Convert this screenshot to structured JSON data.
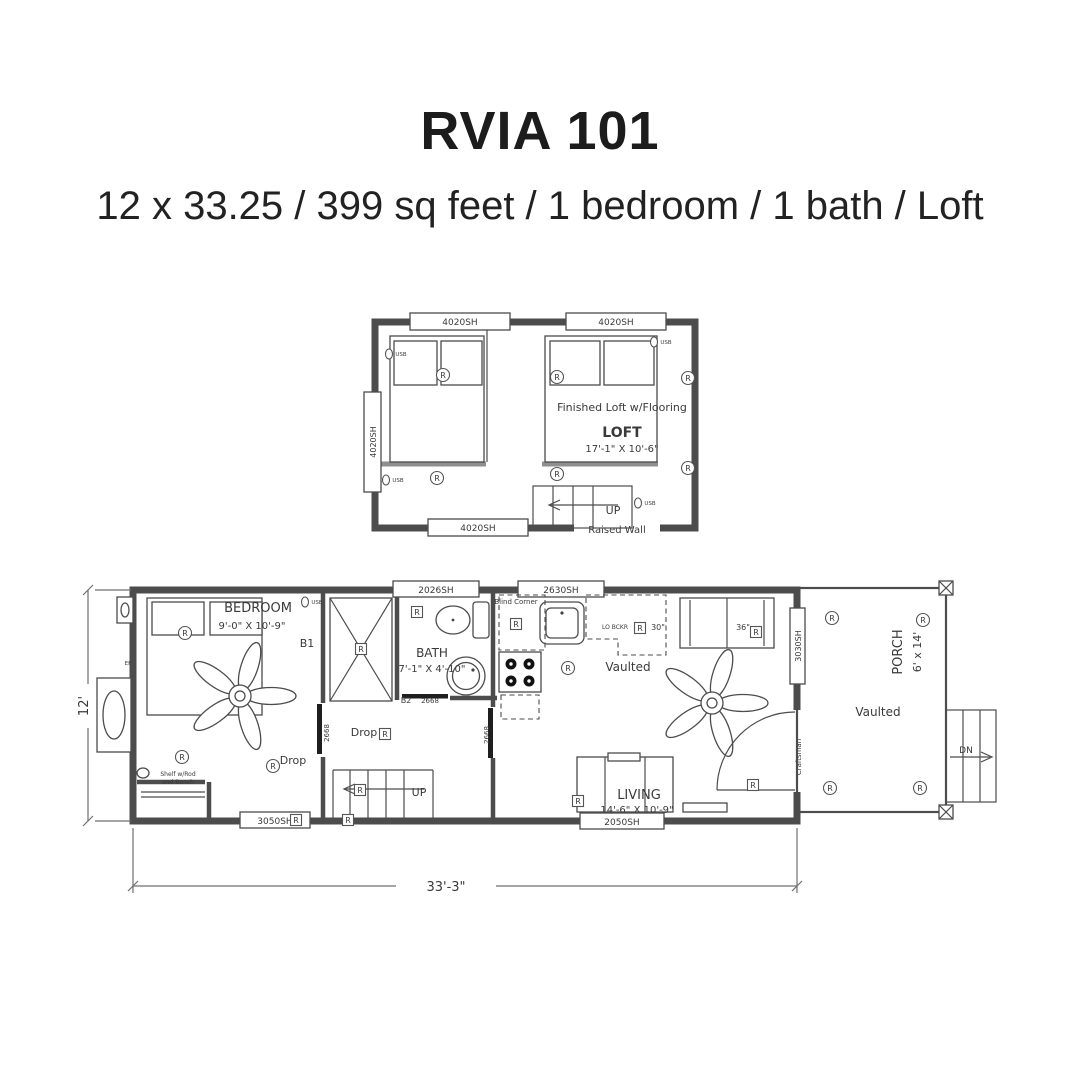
{
  "header": {
    "title": "RVIA 101",
    "subtitle": "12 x 33.25 / 399 sq feet / 1 bedroom / 1 bath / Loft"
  },
  "loft": {
    "win_top_left": "4020SH",
    "win_top_right": "4020SH",
    "win_left": "4020SH",
    "win_bottom": "4020SH",
    "raised_wall": "Raised Wall",
    "note": "Finished Loft w/Flooring",
    "room": "LOFT",
    "room_dims": "17'-1\" X 10'-6\"",
    "up": "UP"
  },
  "main": {
    "bedroom": {
      "name": "BEDROOM",
      "dims": "9'-0\" X 10'-9\"",
      "tag": "B1",
      "drop": "Drop",
      "closet_line1": "Shelf w/Rod",
      "closet_line2": "and Bench",
      "door": "2668",
      "ef": "EF"
    },
    "hall": {
      "drop": "Drop",
      "up": "UP",
      "door": "2668"
    },
    "bath": {
      "name": "BATH",
      "dims": "7'-1\" X 4'-10\"",
      "tag": "B2",
      "door": "2668",
      "window": "2026SH"
    },
    "kitchen": {
      "window": "2630SH",
      "blind_corner": "Blind Corner",
      "lo_bckr": "LO BCKR",
      "cab30": "30\"",
      "vaulted": "Vaulted"
    },
    "living": {
      "name": "LIVING",
      "dims": "14'-6\" X 10'-9\"",
      "window": "2050SH",
      "sofa_width": "36\"",
      "door_label": "Craftsman"
    },
    "windows": {
      "w3050": "3050SH",
      "w3030": "3030SH"
    },
    "porch": {
      "name": "PORCH",
      "dims": "6' x 14'",
      "vaulted": "Vaulted",
      "dn": "DN"
    }
  },
  "dims": {
    "width": "33'-3\"",
    "height": "12'"
  },
  "symbols": {
    "receptacle_label": "R",
    "usb_label": "USB",
    "receptacles_round": [
      [
        443,
        375
      ],
      [
        557,
        377
      ],
      [
        688,
        378
      ],
      [
        437,
        478
      ],
      [
        557,
        474
      ],
      [
        688,
        468
      ],
      [
        185,
        633
      ],
      [
        182,
        757
      ],
      [
        273,
        766
      ],
      [
        568,
        668
      ],
      [
        832,
        618
      ],
      [
        923,
        620
      ],
      [
        830,
        788
      ],
      [
        920,
        788
      ]
    ],
    "receptacles_boxed": [
      [
        417,
        612
      ],
      [
        361,
        649
      ],
      [
        385,
        734
      ],
      [
        360,
        790
      ],
      [
        516,
        624
      ],
      [
        640,
        628
      ],
      [
        756,
        632
      ],
      [
        753,
        785
      ],
      [
        296,
        820
      ],
      [
        348,
        820
      ],
      [
        578,
        801
      ]
    ],
    "usb": [
      [
        399,
        356
      ],
      [
        664,
        344
      ],
      [
        396,
        482
      ],
      [
        648,
        505
      ],
      [
        315,
        604
      ]
    ]
  }
}
